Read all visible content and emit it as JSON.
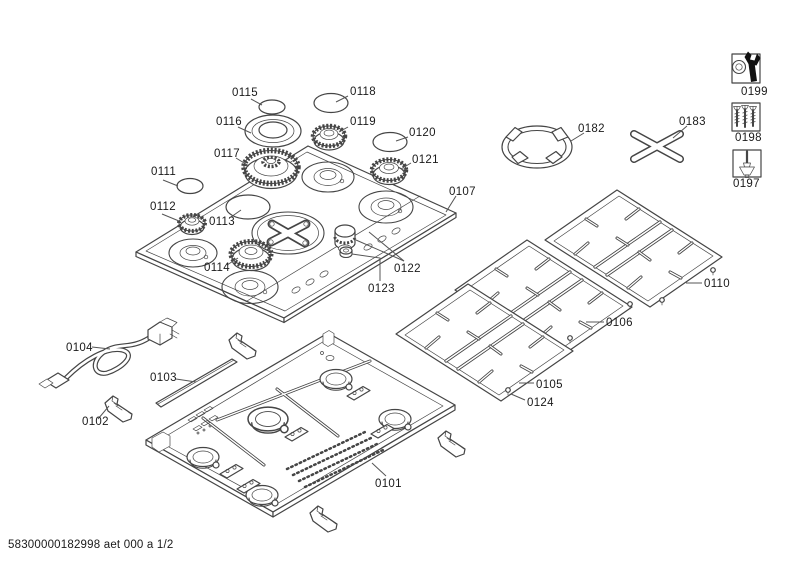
{
  "document": {
    "footer_code": "58300000182998 aet 000 a 1/2"
  },
  "labels": {
    "0101": "0101",
    "0102": "0102",
    "0103": "0103",
    "0104": "0104",
    "0105": "0105",
    "0106": "0106",
    "0107": "0107",
    "0110": "0110",
    "0111": "0111",
    "0112": "0112",
    "0113": "0113",
    "0114": "0114",
    "0115": "0115",
    "0116": "0116",
    "0117": "0117",
    "0118": "0118",
    "0119": "0119",
    "0120": "0120",
    "0121": "0121",
    "0122": "0122",
    "0123": "0123",
    "0124": "0124",
    "0182": "0182",
    "0183": "0183",
    "0197": "0197",
    "0198": "0198",
    "0199": "0199"
  },
  "icons": {
    "0199": "wrench-and-nut-icon",
    "0198": "screws-icon",
    "0197": "screwdriver-nozzle-icon"
  },
  "colors": {
    "line": "#454545",
    "text": "#1a1a1a",
    "background": "#ffffff",
    "icon_fill": "#111111"
  }
}
